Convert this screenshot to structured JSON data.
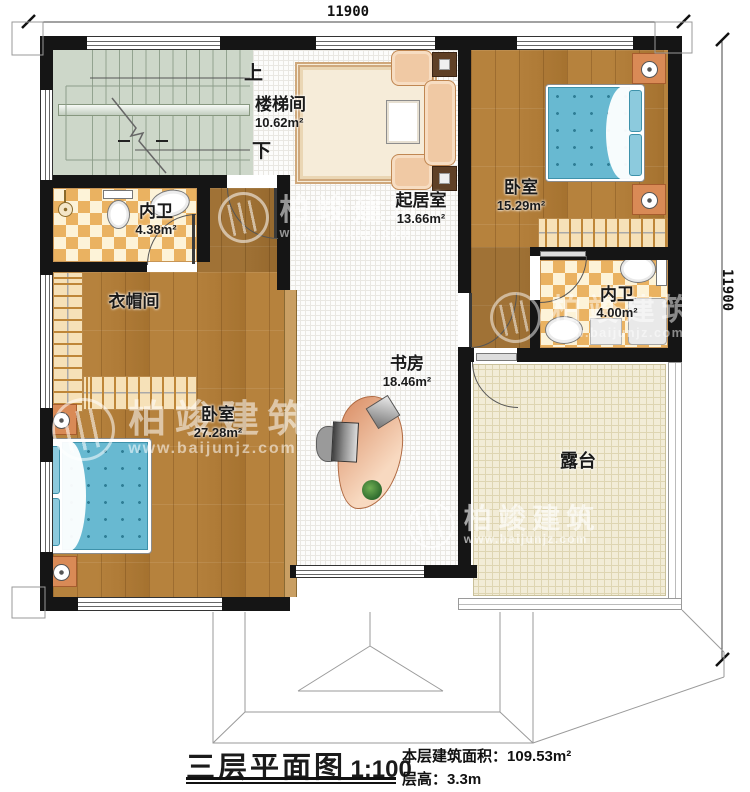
{
  "dimensions": {
    "top": "11900",
    "right": "11900"
  },
  "stair": {
    "up_label": "上",
    "down_label": "下"
  },
  "rooms": {
    "stair": {
      "name": "楼梯间",
      "area": "10.62m²"
    },
    "living": {
      "name": "起居室",
      "area": "13.66m²"
    },
    "bedroom_right": {
      "name": "卧室",
      "area": "15.29m²"
    },
    "bath_left": {
      "name": "内卫",
      "area": "4.38m²"
    },
    "bath_right": {
      "name": "内卫",
      "area": "4.00m²"
    },
    "cloakroom": {
      "name": "衣帽间",
      "area": ""
    },
    "bedroom_left": {
      "name": "卧室",
      "area": "27.28m²"
    },
    "study": {
      "name": "书房",
      "area": "18.46m²"
    },
    "terrace": {
      "name": "露台",
      "area": ""
    }
  },
  "watermark": {
    "brand": "柏竣建筑",
    "url": "www.baijunjz.com"
  },
  "titleblock": {
    "title": "三层平面图",
    "scale": "1:100",
    "area_label": "本层建筑面积：",
    "area_value": "109.53m²",
    "height_label": "层高：",
    "height_value": "3.3m"
  },
  "colors": {
    "wall": "#151515",
    "wood_floor": "#b27b33",
    "checker_tile": "#eab261",
    "stair_floor": "#cdd7c9",
    "terrace_floor": "#f2ecd7",
    "mattress": "#68b9d1",
    "sofa": "#f0c9a4"
  }
}
